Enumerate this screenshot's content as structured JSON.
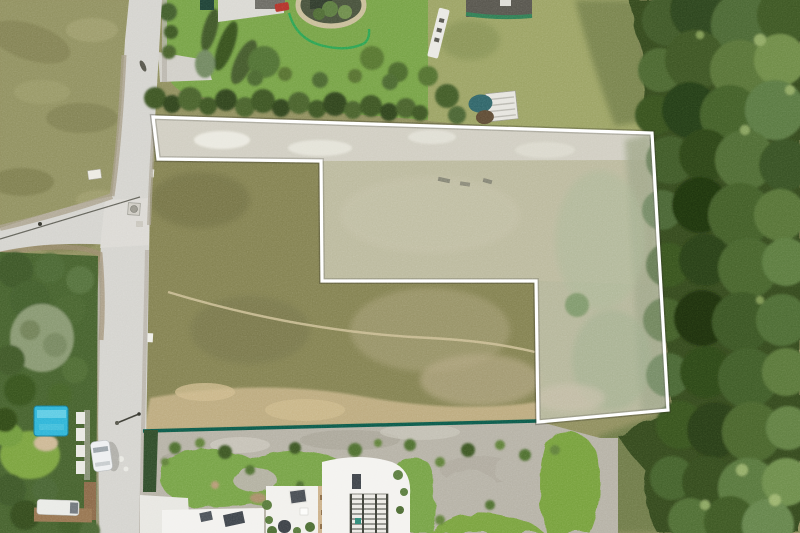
{
  "meta": {
    "title": "Aerial drone photo of a land parcel highlighted with a white boundary outline",
    "image_type": "aerial-photograph",
    "width": 800,
    "height": 533
  },
  "parcel": {
    "name": "highlighted-land-parcel",
    "points": "153,117 652,133 668,410 538,422 536,281 322,281 321,161 158,159",
    "stroke": "#ffffff",
    "fill": "rgba(255,255,255,0.25)",
    "shadow_stroke": "rgba(45,45,32,0.32)"
  },
  "palette": {
    "base_field": "#8f8e5d",
    "road": "#d4d3ce",
    "road_shoulder": "#a59c87",
    "forest": "#31471f",
    "scrub": "#9ba263",
    "lawn": "#76a245",
    "garden_gravel": "#b5b1a5",
    "bare_soil": "#c0bdac",
    "notch_grass": "#838150",
    "sand_band": "#c6b287",
    "teal_fence": "#0d5848",
    "garden_fence_green": "#2ba351",
    "pool_blue": "#2db4d8",
    "pond_ring": "#c8bd99",
    "building_white": "#f2f1ee",
    "red_car": "#b23229",
    "white_car": "#edeff0",
    "van_white": "#e9eae6",
    "tarp_teal": "#2f6468"
  },
  "objects": {
    "parcel_outline": "white surveyed boundary of vacant plot",
    "roads": "asphalt street with T-intersection, left side",
    "forest": "dense tree canopy, right side",
    "pond": "garden pond with stone rim, top",
    "pool": "blue covered pool, lower left",
    "vehicles": "white car on street, white van lower left, red car at top",
    "buildings": "modern white flat-roof houses, bottom",
    "trailer": "construction trailer with teal tarp, top middle",
    "banner": "white advertising banner flag, top middle",
    "teal_fence": "dark green mesh fence along parcel bottom edge"
  }
}
